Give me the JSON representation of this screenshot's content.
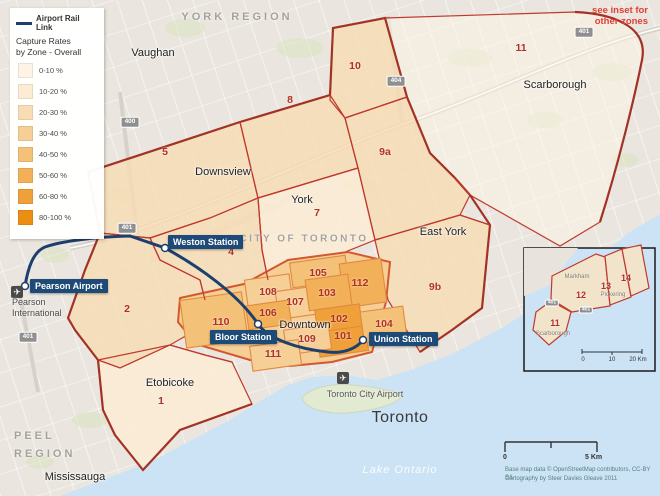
{
  "palette": {
    "c1": "#fdf4e5",
    "c2": "#fcecd3",
    "c3": "#f8dcb4",
    "c4": "#f6cf97",
    "c5": "#f4c178",
    "c6": "#f2b158",
    "c7": "#efa038",
    "c8": "#ec8e12",
    "rail_line": "#1c3f6e",
    "city_border": "#a33226",
    "zone_border": "#bf3a2e",
    "downtown_border": "#d4582d",
    "water": "#cbe3f5",
    "station_bg": "#1d4a76"
  },
  "legend": {
    "line_label": "Airport Rail Link",
    "title_line1": "Capture Rates",
    "title_line2": "by Zone - Overall",
    "items": [
      {
        "label": "0-10 %",
        "color": "#fdf4e5"
      },
      {
        "label": "10-20 %",
        "color": "#fcecd3"
      },
      {
        "label": "20-30 %",
        "color": "#f8dcb4"
      },
      {
        "label": "30-40 %",
        "color": "#f6cf97"
      },
      {
        "label": "40-50 %",
        "color": "#f4c178"
      },
      {
        "label": "50-60 %",
        "color": "#f2b158"
      },
      {
        "label": "60-80 %",
        "color": "#efa038"
      },
      {
        "label": "80-100 %",
        "color": "#ec8e12"
      }
    ]
  },
  "note": {
    "line1": "see inset for",
    "line2": "other zones"
  },
  "stations": {
    "pearson": "Pearson Airport",
    "weston": "Weston Station",
    "bloor": "Bloor Station",
    "union": "Union Station"
  },
  "regions": {
    "york_region": "YORK REGION",
    "peel_line1": "PEEL",
    "peel_line2": "REGION",
    "city_of_toronto": "CITY OF TORONTO"
  },
  "places": {
    "vaughan": "Vaughan",
    "downsview": "Downsview",
    "york": "York",
    "east_york": "East York",
    "scarborough": "Scarborough",
    "etobicoke": "Etobicoke",
    "downtown": "Downtown",
    "mississauga": "Mississauga",
    "toronto": "Toronto",
    "lake_ontario": "Lake Ontario",
    "pearson_intl_line1": "Pearson",
    "pearson_intl_line2": "International",
    "toronto_city_airport": "Toronto City Airport"
  },
  "zones": {
    "outer": [
      "1",
      "2",
      "4",
      "5",
      "7",
      "8",
      "9a",
      "9b",
      "10",
      "11"
    ],
    "downtown": [
      "101",
      "102",
      "103",
      "104",
      "105",
      "106",
      "107",
      "108",
      "109",
      "110",
      "111",
      "112"
    ]
  },
  "inset": {
    "zones": [
      "11",
      "12",
      "13",
      "14"
    ],
    "markham": "Markham",
    "pickering": "Pickering",
    "scarborough": "Scarborough",
    "scale_start": "0",
    "scale_mid": "10",
    "scale_end": "20 Km"
  },
  "highways": {
    "h400": "400",
    "h401": "401",
    "h404": "404"
  },
  "scalebar": {
    "start": "0",
    "end": "5 Km"
  },
  "attribution": {
    "line1": "Base map data © OpenStreetMap contributors, CC-BY SA",
    "line2": "Cartography by Steer Davies Gleave 2011"
  },
  "icons": {
    "airplane": "✈"
  }
}
